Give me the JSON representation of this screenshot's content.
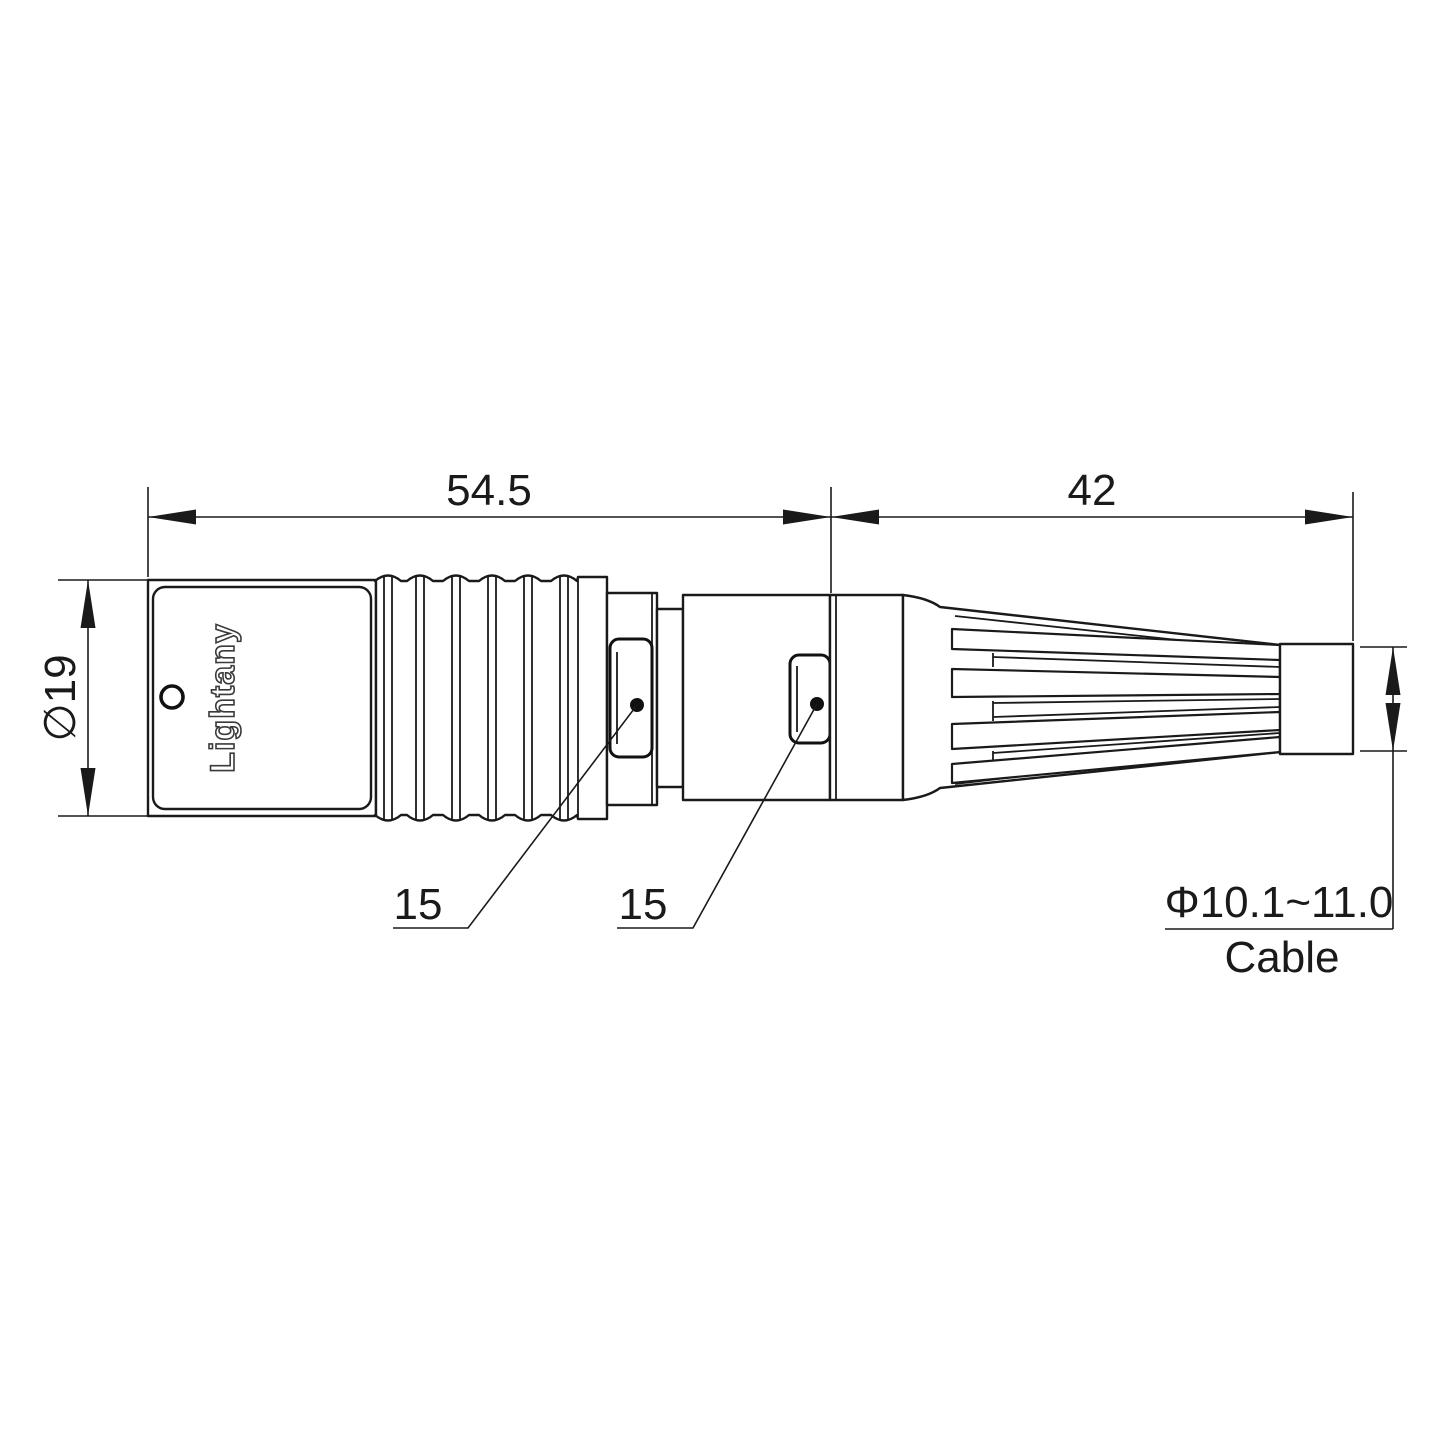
{
  "drawing": {
    "type": "connector-technical-drawing",
    "engraving": "Lightany",
    "watermark": "Lightany",
    "dimensions": {
      "front_length": "54.5",
      "rear_length": "42",
      "body_diameter": "∅19",
      "latch_front": "15",
      "latch_rear": "15",
      "cable_diameter_range": "Φ10.1~11.0",
      "cable_label": "Cable"
    },
    "colors": {
      "line": "#1a1a1a",
      "watermark": "#e89b9b",
      "background": "#ffffff"
    }
  }
}
